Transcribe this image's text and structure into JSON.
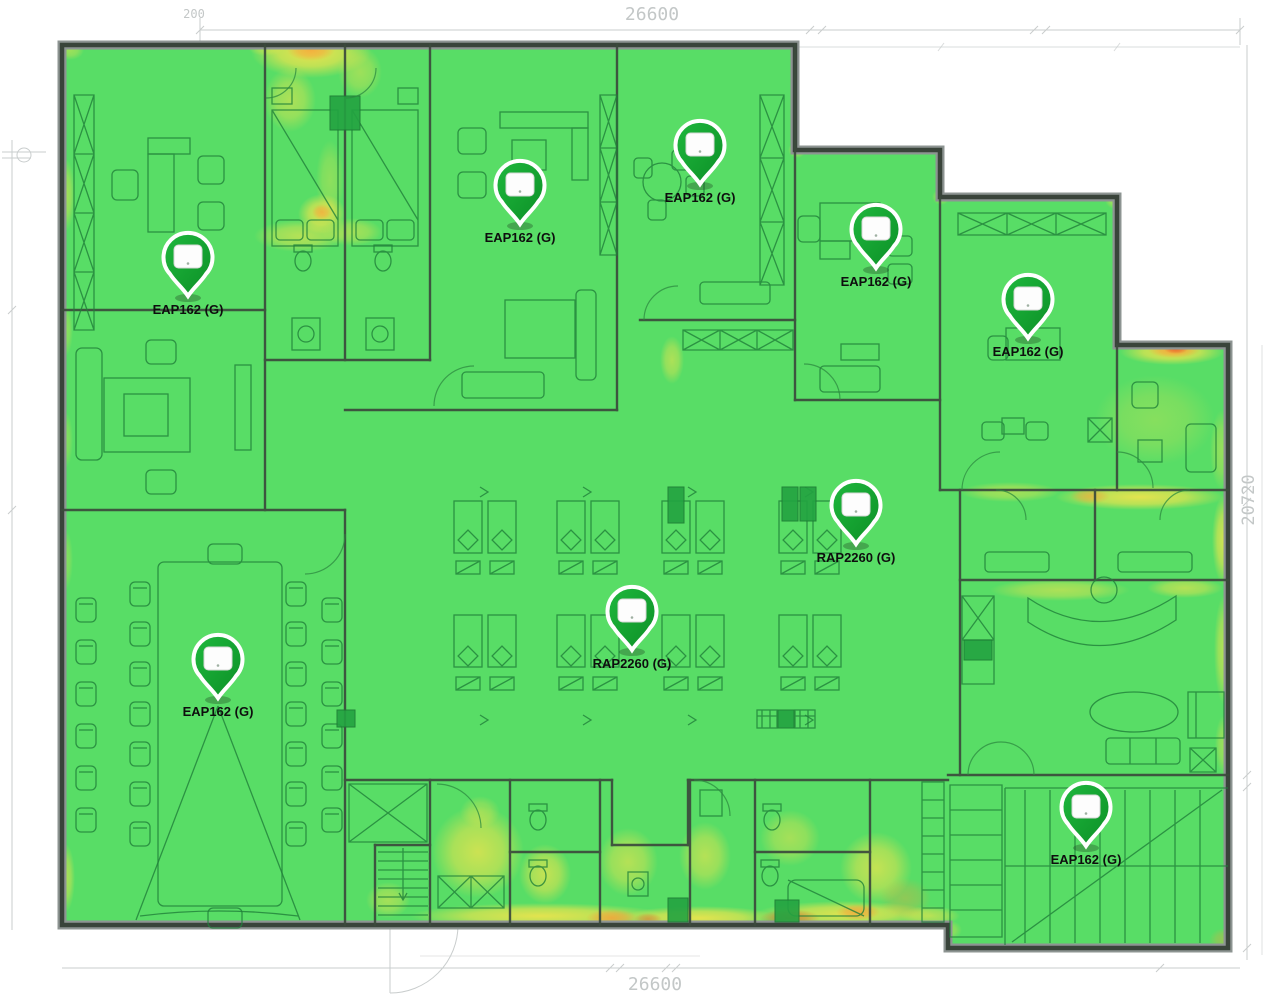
{
  "page": {
    "type": "wifi-coverage-heatmap-floorplan"
  },
  "dimensions": {
    "top_total": "26600",
    "top_left": "200",
    "right_total": "20720",
    "bottom_total": "26600"
  },
  "access_points": [
    {
      "label": "EAP162 (G)",
      "x": 188,
      "y": 296
    },
    {
      "label": "EAP162 (G)",
      "x": 520,
      "y": 224
    },
    {
      "label": "EAP162 (G)",
      "x": 700,
      "y": 184
    },
    {
      "label": "EAP162 (G)",
      "x": 876,
      "y": 268
    },
    {
      "label": "EAP162 (G)",
      "x": 1028,
      "y": 338
    },
    {
      "label": "RAP2260 (G)",
      "x": 856,
      "y": 544
    },
    {
      "label": "RAP2260 (G)",
      "x": 632,
      "y": 650
    },
    {
      "label": "EAP162 (G)",
      "x": 218,
      "y": 698
    },
    {
      "label": "EAP162 (G)",
      "x": 1086,
      "y": 846
    }
  ],
  "heatmap_colors": {
    "strong": "#58DD66",
    "medium": "#F2E44C",
    "weak": "#F5A33A",
    "critical": "#E8622C"
  }
}
